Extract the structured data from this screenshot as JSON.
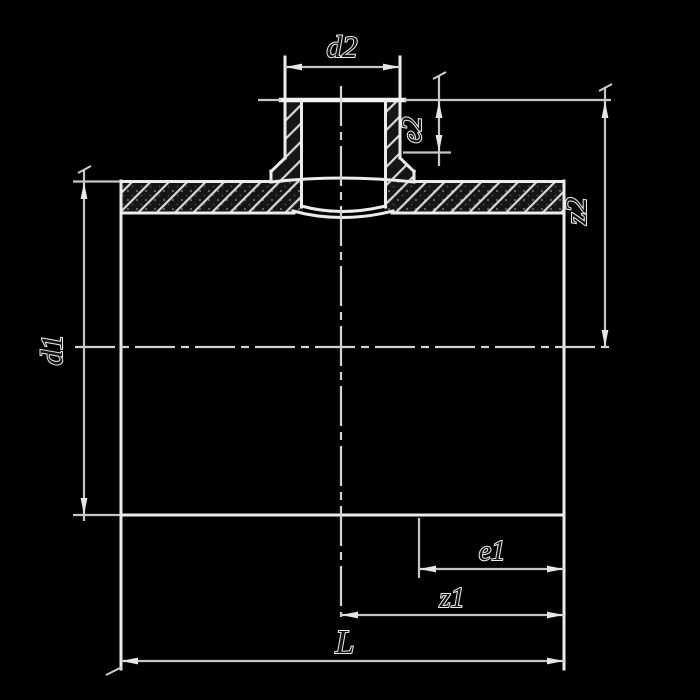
{
  "drawing": {
    "type": "technical-section-pipe-tee",
    "colors": {
      "background": "#000000",
      "outline": "#ececec",
      "dimension_line": "#c6c6c6",
      "hatch": "#d8d8d8",
      "label_outline": "#ececec"
    },
    "dims": {
      "d2": "d2",
      "e2": "e2",
      "z2": "z2",
      "d1": "d1",
      "e1": "e1",
      "z1": "z1",
      "L": "L"
    }
  }
}
